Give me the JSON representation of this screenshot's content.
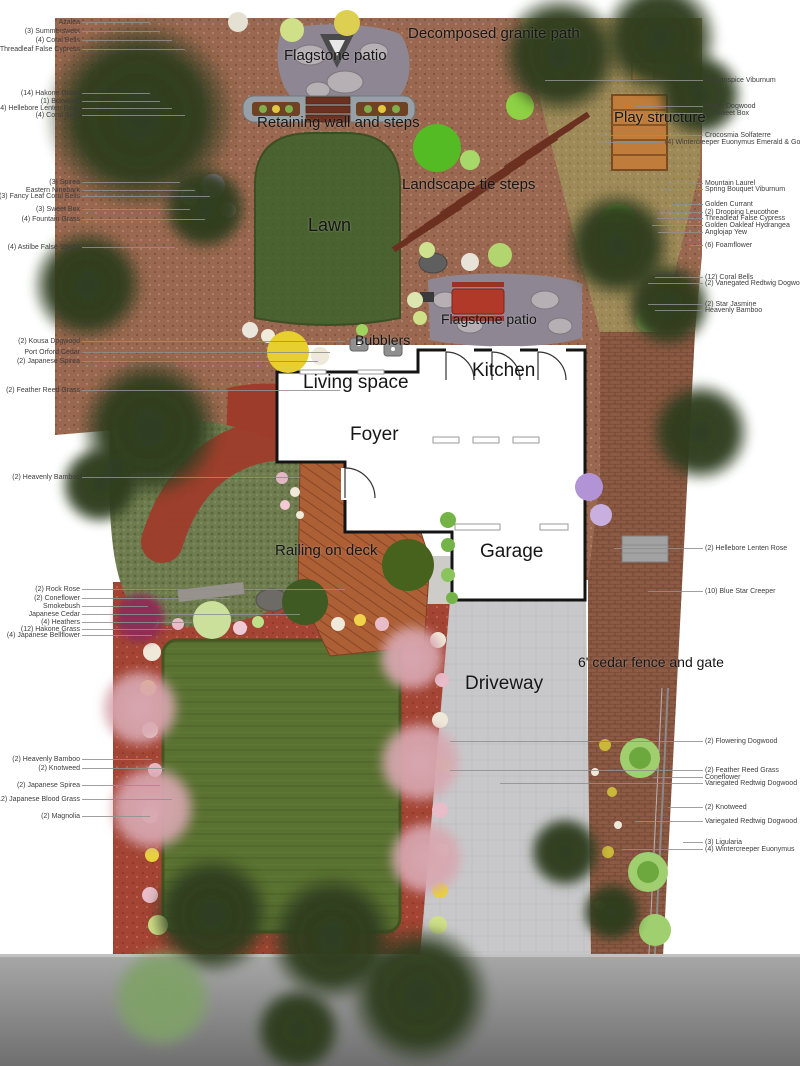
{
  "title": "Residential landscape plan",
  "colors": {
    "mulch": "#9a6850",
    "granite": "#9e8b58",
    "brick": "#8d5a44",
    "red_bed": "#a34434",
    "red_path": "#9e3c2c",
    "back_lawn": "#4a6230",
    "front_lawn": "#5a7231",
    "groundcover": "#6f7c4f",
    "driveway": "#c8c8ca",
    "road_light": "#a8a8a8",
    "road_dark": "#6f6f6f",
    "deck": "#ad5f35",
    "deck_line": "#8a4527",
    "flagstone": "#8e8793",
    "stone": "#b6afb4",
    "wall_stone": "#97a0a6",
    "planter": "#6f4226",
    "tie": "#6b3020",
    "play": "#bf7c3b",
    "house_line": "#141414",
    "tree_dark": "#2e3d1f",
    "tree_pink": "#d8a7b0",
    "tree_light": "#7fa168",
    "magenta_bush": "#8c2f55",
    "leader": "#8f8f8f",
    "label": "#161616"
  },
  "feature_labels": [
    {
      "id": "decomposed-granite-path",
      "text": "Decomposed granite path",
      "x": 408,
      "y": 26,
      "size": 15
    },
    {
      "id": "flagstone-patio-top",
      "text": "Flagstone patio",
      "x": 284,
      "y": 48,
      "size": 15
    },
    {
      "id": "retaining-wall-steps",
      "text": "Retaining wall and steps",
      "x": 257,
      "y": 115,
      "size": 15
    },
    {
      "id": "play-structure",
      "text": "Play structure",
      "x": 614,
      "y": 110,
      "size": 15
    },
    {
      "id": "landscape-tie-steps",
      "text": "Landscape tie steps",
      "x": 402,
      "y": 177,
      "size": 15
    },
    {
      "id": "lawn",
      "text": "Lawn",
      "x": 308,
      "y": 216,
      "size": 18
    },
    {
      "id": "flagstone-patio-mid",
      "text": "Flagstone patio",
      "x": 441,
      "y": 312,
      "size": 14
    },
    {
      "id": "bubblers",
      "text": "Bubblers",
      "x": 355,
      "y": 333,
      "size": 14
    },
    {
      "id": "living-space",
      "text": "Living space",
      "x": 303,
      "y": 373,
      "size": 19
    },
    {
      "id": "kitchen",
      "text": "Kitchen",
      "x": 472,
      "y": 361,
      "size": 19
    },
    {
      "id": "foyer",
      "text": "Foyer",
      "x": 350,
      "y": 425,
      "size": 19
    },
    {
      "id": "railing-on-deck",
      "text": "Railing on deck",
      "x": 275,
      "y": 543,
      "size": 15
    },
    {
      "id": "garage",
      "text": "Garage",
      "x": 480,
      "y": 542,
      "size": 19
    },
    {
      "id": "driveway",
      "text": "Driveway",
      "x": 465,
      "y": 674,
      "size": 19
    },
    {
      "id": "cedar-fence-gate",
      "text": "6' cedar fence and gate",
      "x": 578,
      "y": 655,
      "size": 14
    }
  ],
  "plant_labels": {
    "left_text_x": 80,
    "right_text_x": 705,
    "left": [
      {
        "text": "Azalea",
        "y": 23,
        "target_x": 150
      },
      {
        "text": "(3) Summersweet",
        "y": 32,
        "target_x": 160
      },
      {
        "text": "(4) Coral Bells",
        "y": 41,
        "target_x": 172
      },
      {
        "text": "Threadleaf False Cypress",
        "y": 50,
        "target_x": 185
      },
      {
        "text": "(14) Hakone Grass",
        "y": 94,
        "target_x": 150
      },
      {
        "text": "(1) Boxwood",
        "y": 102,
        "target_x": 160
      },
      {
        "text": "(4) Hellebore Lenten Rose",
        "y": 109,
        "target_x": 172
      },
      {
        "text": "(4) Coral Bells",
        "y": 116,
        "target_x": 185
      },
      {
        "text": "(3) Spirea",
        "y": 183,
        "target_x": 180
      },
      {
        "text": "Eastern Ninebark",
        "y": 191,
        "target_x": 195
      },
      {
        "text": "(3) Fancy Leaf Coral Bells",
        "y": 197,
        "target_x": 210
      },
      {
        "text": "(3) Sweet Box",
        "y": 210,
        "target_x": 190
      },
      {
        "text": "(4) Fountain Grass",
        "y": 220,
        "target_x": 205
      },
      {
        "text": "(4) Astilbe False Spirea",
        "y": 248,
        "target_x": 175
      },
      {
        "text": "(2) Kousa Dogwood",
        "y": 342,
        "target_x": 345
      },
      {
        "text": "Port Orford Cedar",
        "y": 353,
        "target_x": 330
      },
      {
        "text": "(2) Japanese Spirea",
        "y": 362,
        "target_x": 318
      },
      {
        "text": "(2) Feather Reed Grass",
        "y": 391,
        "target_x": 340
      },
      {
        "text": "(2) Heavenly Bamboo",
        "y": 478,
        "target_x": 300
      },
      {
        "text": "(2) Rock Rose",
        "y": 590,
        "target_x": 345
      },
      {
        "text": "(2) Coneflower",
        "y": 599,
        "target_x": 230
      },
      {
        "text": "Smokebush",
        "y": 607,
        "target_x": 148
      },
      {
        "text": "Japanese Cedar",
        "y": 615,
        "target_x": 300
      },
      {
        "text": "(4) Heathers",
        "y": 623,
        "target_x": 192
      },
      {
        "text": "(12) Hakone Grass",
        "y": 630,
        "target_x": 172
      },
      {
        "text": "(4) Japanese Bellflower",
        "y": 636,
        "target_x": 152
      },
      {
        "text": "(2) Heavenly Bamboo",
        "y": 760,
        "target_x": 152
      },
      {
        "text": "(2) Knotweed",
        "y": 769,
        "target_x": 165
      },
      {
        "text": "(2) Japanese Spirea",
        "y": 786,
        "target_x": 160
      },
      {
        "text": "(12) Japanese Blood Grass",
        "y": 800,
        "target_x": 172
      },
      {
        "text": "(2) Magnolia",
        "y": 817,
        "target_x": 150
      }
    ],
    "right": [
      {
        "text": "Koreanspice Viburnum",
        "y": 81,
        "target_x": 545
      },
      {
        "text": "Marlin Dogwood",
        "y": 107,
        "target_x": 635
      },
      {
        "text": "(4) Sweet Box",
        "y": 114,
        "target_x": 650
      },
      {
        "text": "Crocosmia Solfaterre",
        "y": 136,
        "target_x": 600
      },
      {
        "text": "(4) Wintercreeper Euonymus Emerald & Gold",
        "y": 143,
        "target_x": 598,
        "x": 665
      },
      {
        "text": "Mountain Laurel",
        "y": 184,
        "target_x": 668
      },
      {
        "text": "Spring Bouquet Viburnum",
        "y": 190,
        "target_x": 662
      },
      {
        "text": "Golden Currant",
        "y": 205,
        "target_x": 672
      },
      {
        "text": "(2) Drooping Leucothoe",
        "y": 213,
        "target_x": 660
      },
      {
        "text": "Threadleaf False Cypress",
        "y": 219,
        "target_x": 657
      },
      {
        "text": "Golden Oakleaf Hydrangea",
        "y": 226,
        "target_x": 652
      },
      {
        "text": "Anglojap Yew",
        "y": 233,
        "target_x": 658
      },
      {
        "text": "(6) Foamflower",
        "y": 246,
        "target_x": 690
      },
      {
        "text": "(12) Coral Bells",
        "y": 278,
        "target_x": 655
      },
      {
        "text": "(2) Variegated Redtwig Dogwood",
        "y": 284,
        "target_x": 648
      },
      {
        "text": "(2) Star Jasmine",
        "y": 305,
        "target_x": 648
      },
      {
        "text": "Heavenly Bamboo",
        "y": 311,
        "target_x": 655
      },
      {
        "text": "(2) Hellebore Lenten Rose",
        "y": 549,
        "target_x": 614
      },
      {
        "text": "(10) Blue Star Creeper",
        "y": 592,
        "target_x": 648
      },
      {
        "text": "(2) Flowering Dogwood",
        "y": 742,
        "target_x": 450
      },
      {
        "text": "(2) Feather Reed Grass",
        "y": 771,
        "target_x": 450
      },
      {
        "text": "Coneflower",
        "y": 778,
        "target_x": 653
      },
      {
        "text": "Variegated Redtwig Dogwood",
        "y": 784,
        "target_x": 500
      },
      {
        "text": "(2) Knotweed",
        "y": 808,
        "target_x": 668
      },
      {
        "text": "Variegated Redtwig Dogwood",
        "y": 822,
        "target_x": 635
      },
      {
        "text": "(3) Ligularia",
        "y": 843,
        "target_x": 683
      },
      {
        "text": "(4) Wintercreeper Euonymus",
        "y": 850,
        "target_x": 622
      }
    ]
  },
  "rooms": [
    "Living space",
    "Kitchen",
    "Foyer",
    "Garage"
  ],
  "site_features": [
    "Flagstone patio",
    "Decomposed granite path",
    "Retaining wall and steps",
    "Play structure",
    "Landscape tie steps",
    "Lawn",
    "Bubblers",
    "Railing on deck",
    "Driveway",
    "6' cedar fence and gate"
  ]
}
